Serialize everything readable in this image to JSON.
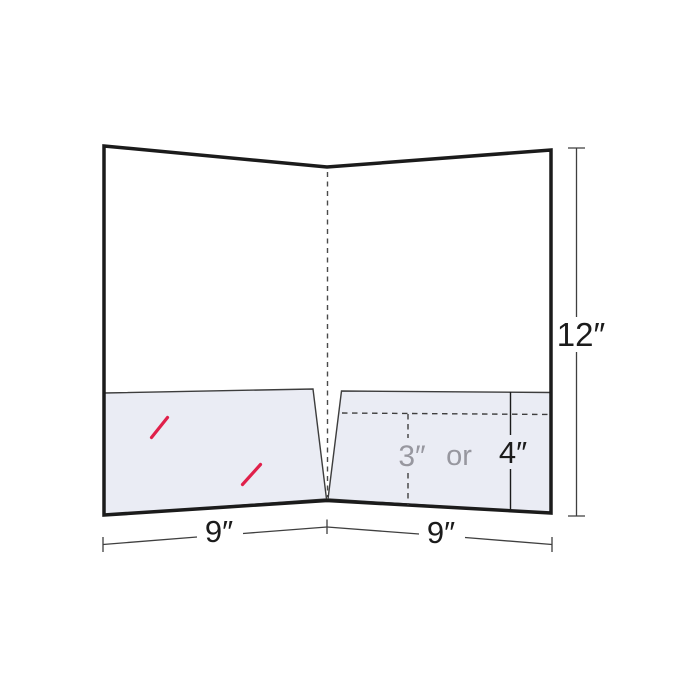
{
  "diagram": {
    "labels": {
      "folder_height": "12″",
      "left_panel_width": "9″",
      "right_panel_width": "9″",
      "pocket_height_small": "3″",
      "conjunction": "or",
      "pocket_height_large": "4″"
    },
    "colors": {
      "background": "#ffffff",
      "outline": "#1b1b1b",
      "pocket_fill": "#eaecf4",
      "pocket_edge": "#3d3d3d",
      "fold_line": "#4a4a4a",
      "dimension_line": "#3f3f3f",
      "slit_red": "#e0204a",
      "gray_label": "#97979f",
      "black_label": "#1b1b1b"
    }
  }
}
